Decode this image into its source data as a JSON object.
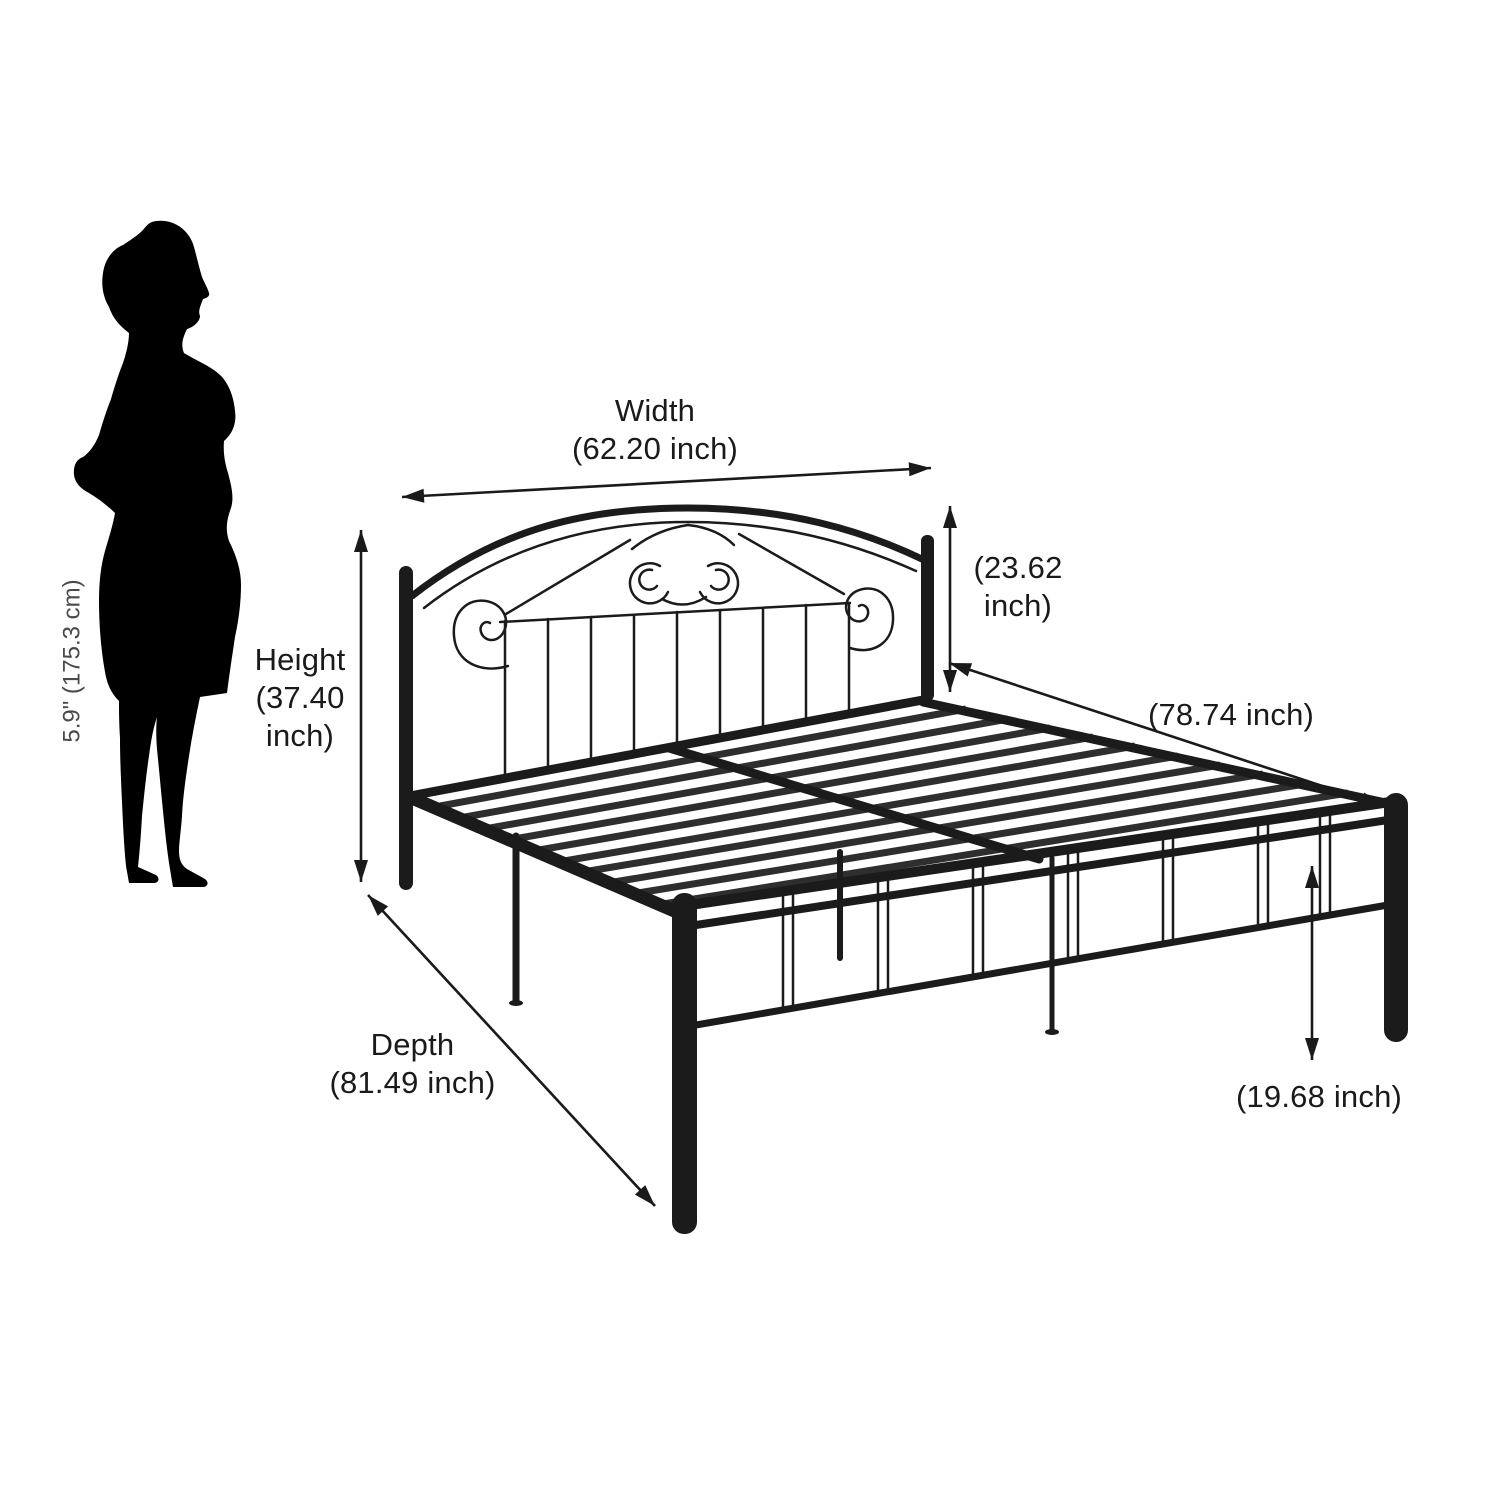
{
  "figure": {
    "alt": "Black metal bed frame dimension diagram with woman silhouette for scale"
  },
  "person_scale": {
    "height_label": "5.9\" (175.3 cm)"
  },
  "dimensions": {
    "width": {
      "label": "Width",
      "value": "(62.20 inch)"
    },
    "height": {
      "lines": [
        "Height",
        "(37.40",
        "inch)"
      ]
    },
    "headboard_height": {
      "lines": [
        "(23.62",
        "inch)"
      ]
    },
    "length": {
      "value": "(78.74 inch)"
    },
    "depth": {
      "label": "Depth",
      "value": "(81.49 inch)"
    },
    "leg_height": {
      "value": "(19.68 inch)"
    }
  },
  "colors": {
    "ink": "#1a1a1a",
    "silhouette": "#000000",
    "frame": "#1b1b1b",
    "slat": "#2e2e2e",
    "background": "#ffffff",
    "person_label": "#4a4a4a"
  }
}
